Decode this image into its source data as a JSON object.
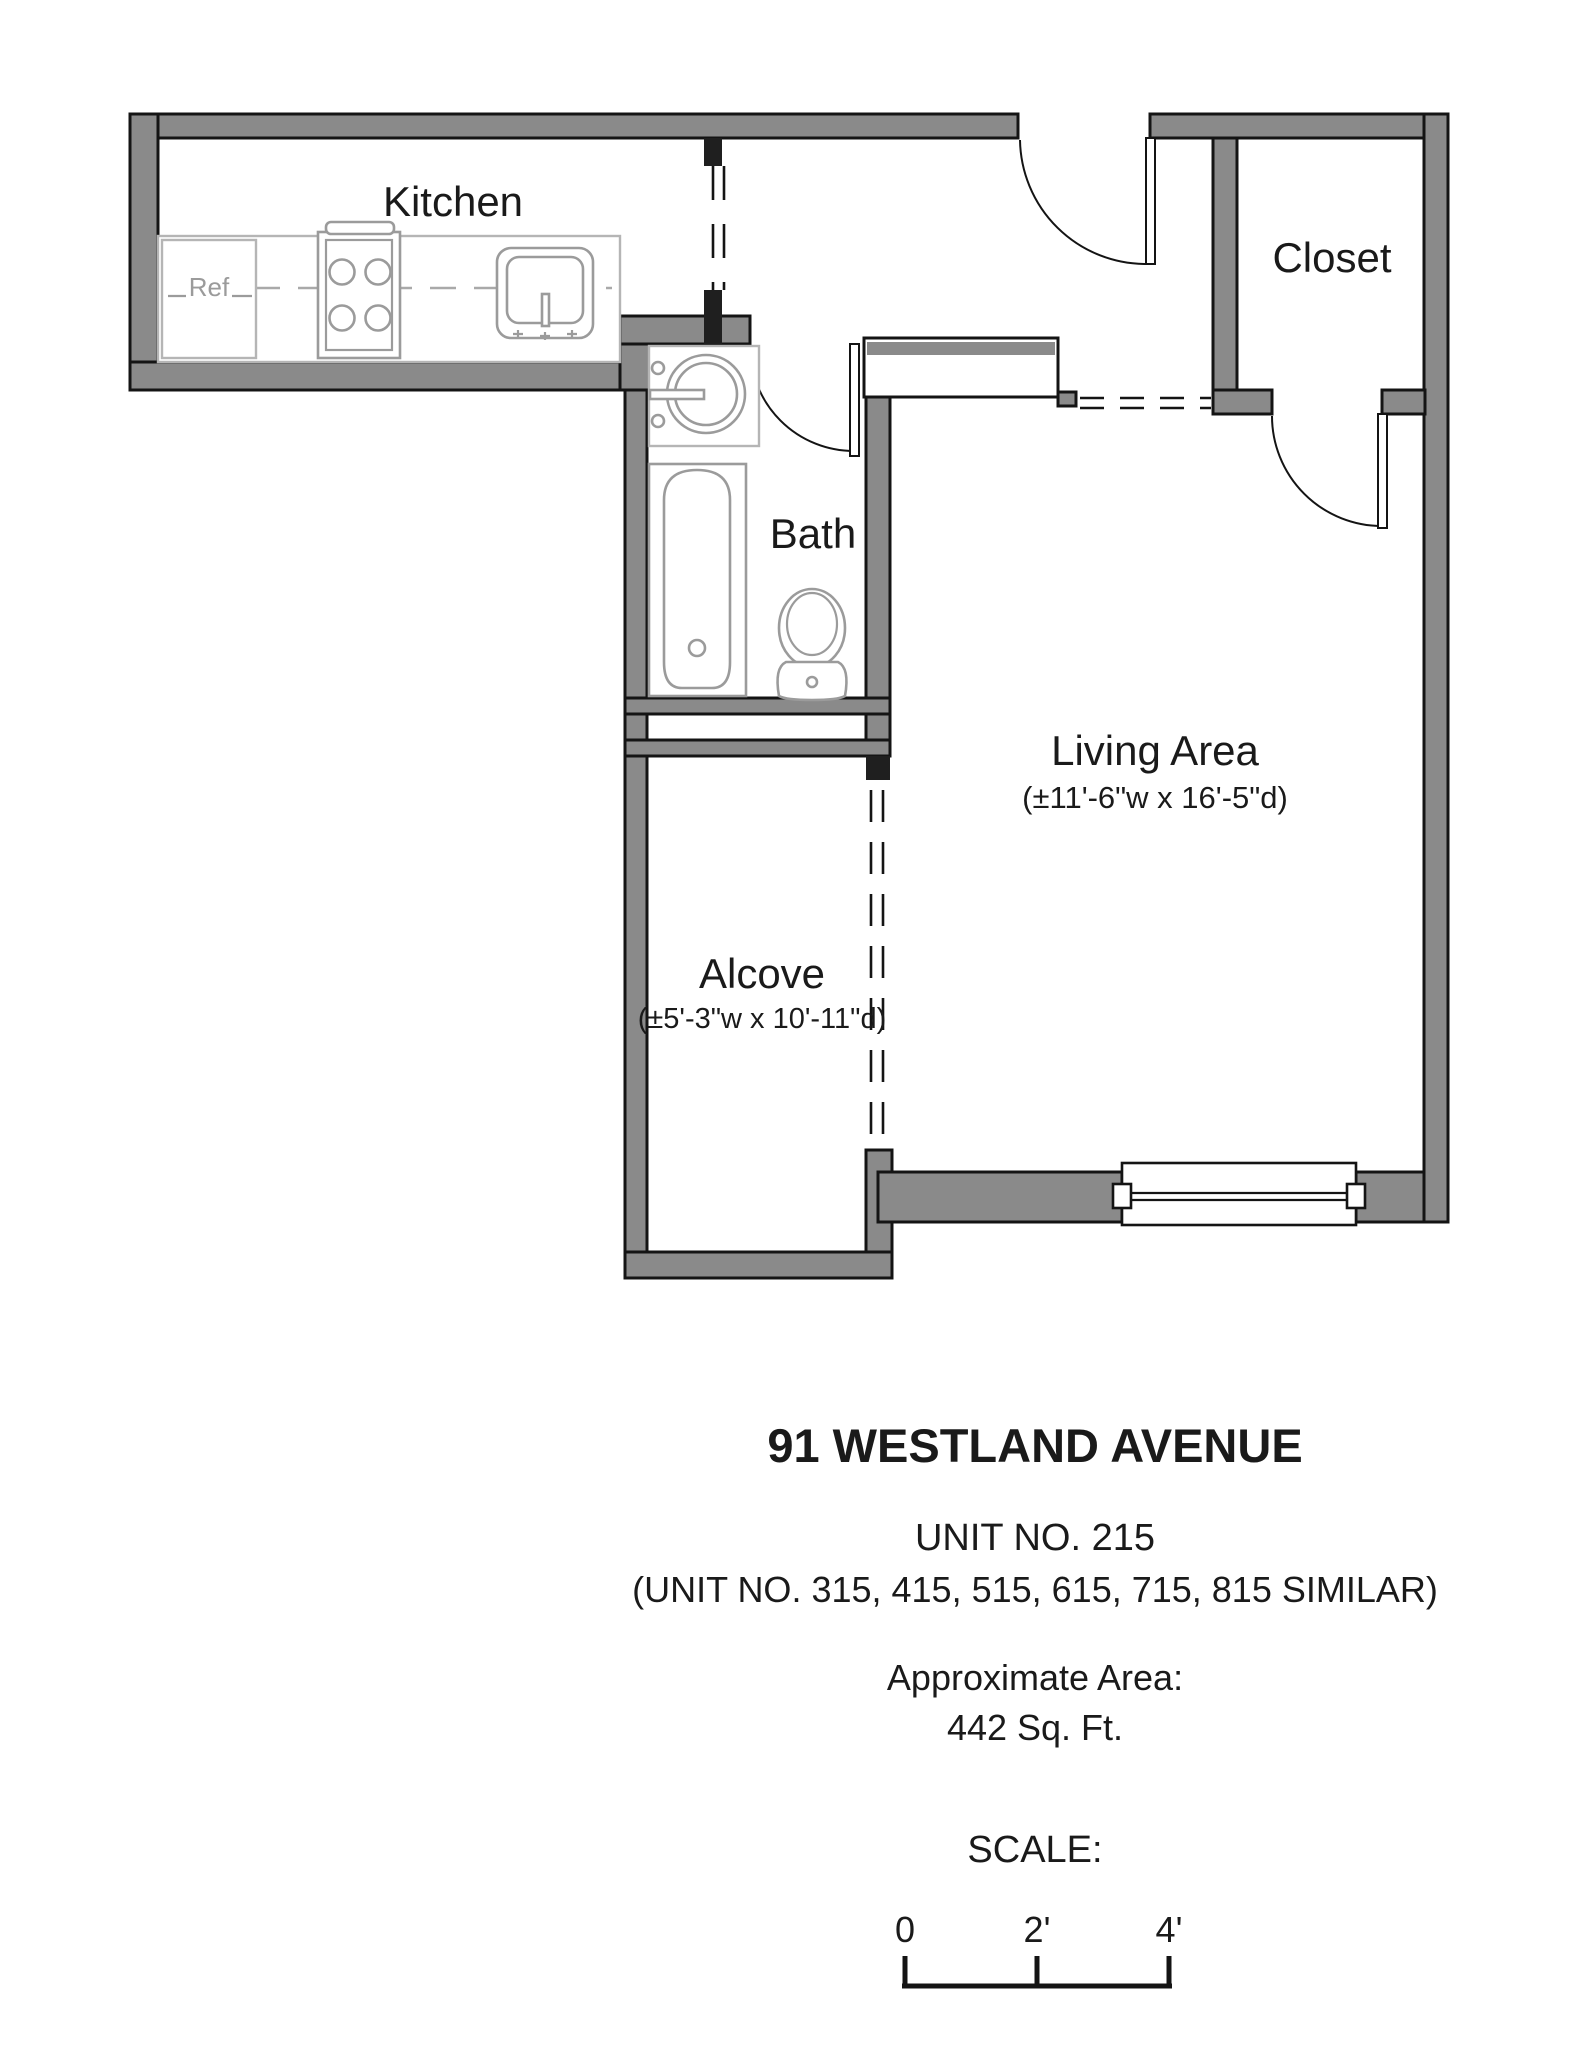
{
  "plan": {
    "rooms": {
      "kitchen": {
        "label": "Kitchen"
      },
      "closet": {
        "label": "Closet"
      },
      "bath": {
        "label": "Bath"
      },
      "living_area": {
        "label": "Living Area",
        "dimensions": "(±11'-6\"w x 16'-5\"d)"
      },
      "alcove": {
        "label": "Alcove",
        "dimensions": "(±5'-3\"w x 10'-11\"d)"
      }
    },
    "fixtures": {
      "refrigerator_label": "Ref",
      "icons": [
        "stove-icon",
        "kitchen-sink-icon",
        "bath-sink-icon",
        "bathtub-icon",
        "toilet-icon",
        "window",
        "door-swing"
      ]
    }
  },
  "title_block": {
    "address": "91 WESTLAND AVENUE",
    "unit_number": "UNIT NO. 215",
    "similar_units": "(UNIT NO. 315, 415, 515, 615, 715, 815 SIMILAR)",
    "area_label": "Approximate Area:",
    "area_value": "442 Sq. Ft.",
    "scale_label": "SCALE:",
    "scale_ticks": [
      "0",
      "2'",
      "4'"
    ]
  },
  "colors": {
    "wall_fill": "#8a8a8a",
    "outline": "#141414",
    "fixture_line": "#9b9b9b",
    "counter_line": "#b5b5b5",
    "text": "#1a1a1a",
    "background": "#ffffff"
  }
}
